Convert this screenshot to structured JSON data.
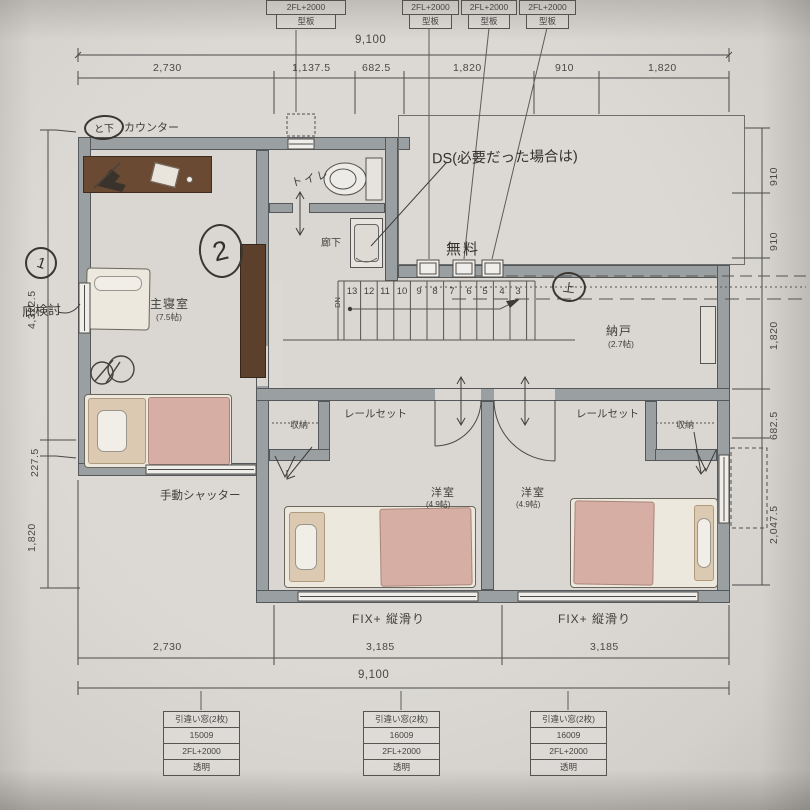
{
  "handwritten": {
    "updown": "と下",
    "circle_1": "1",
    "circle_2": "2",
    "eave_note": "庇検討",
    "ds_note": "DS(必要だった場合は)",
    "free_note": "無料",
    "up_mark": "上"
  },
  "labels": {
    "counter": "カウンター",
    "shutter": "手動シャッター",
    "rail_left": "レールセット",
    "rail_right": "レールセット",
    "fix_left": "FIX+ 縦滑り",
    "fix_right": "FIX+ 縦滑り",
    "dn": "DN"
  },
  "rooms": {
    "master_name": "主寝室",
    "master_size": "(7.5帖)",
    "toilet": "トイレ",
    "hallway": "廊下",
    "storage_name": "納戸",
    "storage_size": "(2.7帖)",
    "west1_name": "洋室",
    "west1_size": "(4.9帖)",
    "west2_name": "洋室",
    "west2_size": "(4.9帖)",
    "closet_left": "収納",
    "closet_right": "収納"
  },
  "stairs": {
    "numbers": [
      "13",
      "12",
      "11",
      "10",
      "9",
      "8",
      "7",
      "6",
      "5",
      "4",
      "3"
    ]
  },
  "dimensions": {
    "top_total": "9,100",
    "top_segments": [
      "2,730",
      "1,137.5",
      "682.5",
      "1,820",
      "910",
      "1,820"
    ],
    "left_segments": [
      "4,322.5",
      "227.5",
      "1,820"
    ],
    "right_segments": [
      "910",
      "910",
      "1,820",
      "682.5",
      "2,047.5"
    ],
    "bottom_segments": [
      "2,730",
      "3,185",
      "3,185"
    ],
    "bottom_total": "9,100"
  },
  "window_tags_top": [
    {
      "line1": "2FL+2000",
      "line2": "型板"
    },
    {
      "line1": "2FL+2000",
      "line2": "型板"
    },
    {
      "line1": "2FL+2000",
      "line2": "型板"
    },
    {
      "line1": "2FL+2000",
      "line2": "型板"
    }
  ],
  "window_tags_bottom": [
    {
      "type": "引違い窓(2枚)",
      "code": "15009",
      "height": "2FL+2000",
      "glass": "透明"
    },
    {
      "type": "引違い窓(2枚)",
      "code": "16009",
      "height": "2FL+2000",
      "glass": "透明"
    },
    {
      "type": "引違い窓(2枚)",
      "code": "16009",
      "height": "2FL+2000",
      "glass": "透明"
    }
  ]
}
